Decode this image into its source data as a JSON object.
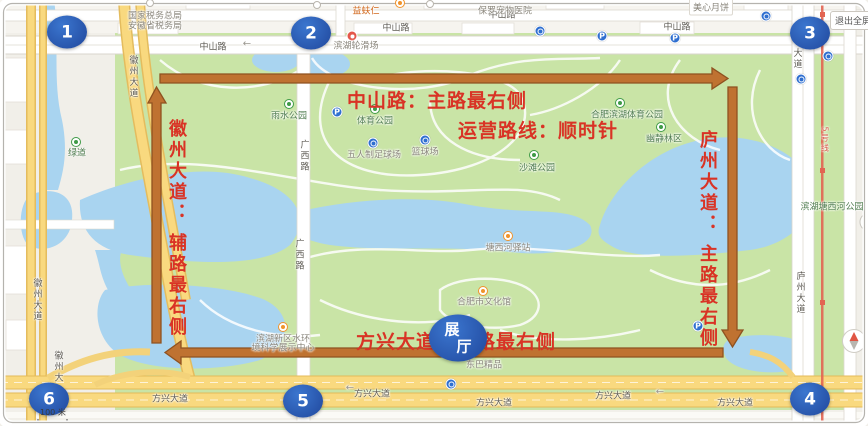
{
  "ui": {
    "exit_fullscreen": "退出全屏",
    "scale_text": "100 米"
  },
  "annotations": {
    "top_road": "中山路：主路最右侧",
    "route_direction": "运营路线：顺时针",
    "left_road": "徽州大道： 辅路最右侧",
    "right_road": "庐州大道： 主路最右侧",
    "bottom_road": "方兴大道：主路最右侧",
    "hall_top": "展",
    "hall_bottom": "厅"
  },
  "colors": {
    "annotation_red": "#d93325",
    "arrow_orange": "#bf7231",
    "marker_blue": "#2a5cb0",
    "water": "#a9d4f0",
    "park_green": "#c9e4a6",
    "road_yellow": "#f8d77c"
  },
  "route_markers": [
    {
      "n": "1",
      "x": 67,
      "y": 32
    },
    {
      "n": "2",
      "x": 311,
      "y": 33
    },
    {
      "n": "3",
      "x": 810,
      "y": 33
    },
    {
      "n": "4",
      "x": 810,
      "y": 399
    },
    {
      "n": "5",
      "x": 303,
      "y": 401
    },
    {
      "n": "6",
      "x": 49,
      "y": 399
    }
  ],
  "map_labels": [
    {
      "t": "国家税务总局",
      "x": 155,
      "y": 15,
      "cls": "bldg"
    },
    {
      "t": "安徽省税务局",
      "x": 155,
      "y": 25,
      "cls": "bldg"
    },
    {
      "t": "中山路",
      "x": 213,
      "y": 46,
      "cls": "road"
    },
    {
      "t": "中山路",
      "x": 396,
      "y": 27,
      "cls": "road"
    },
    {
      "t": "中山路",
      "x": 502,
      "y": 14,
      "cls": "road"
    },
    {
      "t": "中山路",
      "x": 677,
      "y": 26,
      "cls": "road"
    },
    {
      "t": "益蚨仁",
      "x": 366,
      "y": 10,
      "cls": "orange"
    },
    {
      "t": "保罗宠物医院",
      "x": 505,
      "y": 10,
      "cls": "bldg"
    },
    {
      "t": "美心月饼",
      "x": 711,
      "y": 7,
      "cls": "bldg bubble"
    },
    {
      "t": "滨湖轮滑场",
      "x": 356,
      "y": 45,
      "cls": "bldg"
    },
    {
      "t": "雨水公园",
      "x": 289,
      "y": 115,
      "cls": "park"
    },
    {
      "t": "体育公园",
      "x": 375,
      "y": 120,
      "cls": "park"
    },
    {
      "t": "五人制足球场",
      "x": 374,
      "y": 154,
      "cls": "bldg"
    },
    {
      "t": "篮球场",
      "x": 425,
      "y": 151,
      "cls": "bldg"
    },
    {
      "t": "沙滩公园",
      "x": 537,
      "y": 167,
      "cls": "park"
    },
    {
      "t": "合肥滨湖体育公园",
      "x": 627,
      "y": 114,
      "cls": "park"
    },
    {
      "t": "幽静林区",
      "x": 664,
      "y": 138,
      "cls": "park"
    },
    {
      "t": "滨湖塘西河公园",
      "x": 832,
      "y": 206,
      "cls": "park"
    },
    {
      "t": "塘西河驿站",
      "x": 508,
      "y": 247,
      "cls": "bldg"
    },
    {
      "t": "合肥市文化馆",
      "x": 484,
      "y": 301,
      "cls": "bldg"
    },
    {
      "t": "滨湖新区水环",
      "x": 283,
      "y": 338,
      "cls": "bldg"
    },
    {
      "t": "境科学展示中心",
      "x": 283,
      "y": 347,
      "cls": "bldg"
    },
    {
      "t": "东巴精品",
      "x": 484,
      "y": 364,
      "cls": "bldg"
    },
    {
      "t": "方兴大道",
      "x": 170,
      "y": 398,
      "cls": "road"
    },
    {
      "t": "方兴大道",
      "x": 372,
      "y": 393,
      "cls": "road"
    },
    {
      "t": "方兴大道",
      "x": 494,
      "y": 402,
      "cls": "road"
    },
    {
      "t": "方兴大道",
      "x": 613,
      "y": 395,
      "cls": "road"
    },
    {
      "t": "方兴大道",
      "x": 735,
      "y": 402,
      "cls": "road"
    },
    {
      "t": "广西路",
      "x": 304,
      "y": 156,
      "cls": "road",
      "v": true
    },
    {
      "t": "广西路",
      "x": 299,
      "y": 255,
      "cls": "road",
      "v": true
    },
    {
      "t": "徽州大道",
      "x": 133,
      "y": 77,
      "cls": "road",
      "v": true
    },
    {
      "t": "徽州大道",
      "x": 37,
      "y": 300,
      "cls": "road",
      "v": true
    },
    {
      "t": "徽州大",
      "x": 58,
      "y": 367,
      "cls": "road",
      "v": true
    },
    {
      "t": "大道",
      "x": 797,
      "y": 59,
      "cls": "road",
      "v": true
    },
    {
      "t": "庐州大道",
      "x": 800,
      "y": 293,
      "cls": "road",
      "v": true
    },
    {
      "t": "绿道",
      "x": 77,
      "y": 152,
      "cls": "park"
    },
    {
      "t": "5号线",
      "x": 825,
      "y": 140,
      "cls": "metro",
      "v": true
    },
    {
      "t": "←",
      "x": 247,
      "y": 44,
      "cls": "dir"
    },
    {
      "t": "←",
      "x": 350,
      "y": 388,
      "cls": "dir"
    },
    {
      "t": "←",
      "x": 660,
      "y": 392,
      "cls": "dir"
    }
  ],
  "poi_icons": [
    {
      "type": "parking-icon",
      "x": 337,
      "y": 112,
      "g": "P"
    },
    {
      "type": "parking-icon",
      "x": 602,
      "y": 36,
      "g": "P"
    },
    {
      "type": "parking-icon",
      "x": 675,
      "y": 38,
      "g": "P"
    },
    {
      "type": "parking-icon",
      "x": 698,
      "y": 326,
      "g": "P"
    },
    {
      "type": "transit-icon",
      "x": 766,
      "y": 16
    },
    {
      "type": "transit-icon",
      "x": 828,
      "y": 56
    },
    {
      "type": "transit-icon",
      "x": 801,
      "y": 79
    },
    {
      "type": "transit-icon",
      "x": 451,
      "y": 384
    },
    {
      "type": "transit-icon",
      "x": 540,
      "y": 31
    },
    {
      "type": "sport-icon",
      "x": 373,
      "y": 143
    },
    {
      "type": "sport-icon",
      "x": 425,
      "y": 140
    },
    {
      "type": "park-icon",
      "x": 289,
      "y": 104
    },
    {
      "type": "park-icon",
      "x": 375,
      "y": 109
    },
    {
      "type": "park-icon",
      "x": 620,
      "y": 103
    },
    {
      "type": "park-icon",
      "x": 661,
      "y": 127
    },
    {
      "type": "park-icon",
      "x": 534,
      "y": 155
    },
    {
      "type": "park-icon",
      "x": 76,
      "y": 142
    },
    {
      "type": "orange-icon",
      "x": 483,
      "y": 291
    },
    {
      "type": "orange-icon",
      "x": 283,
      "y": 327
    },
    {
      "type": "orange-icon",
      "x": 508,
      "y": 236
    },
    {
      "type": "orange-icon",
      "x": 400,
      "y": 3
    },
    {
      "type": "red-icon",
      "x": 352,
      "y": 36
    },
    {
      "type": "white-icon",
      "x": 430,
      "y": 4
    },
    {
      "type": "white-icon",
      "x": 150,
      "y": 3
    },
    {
      "type": "white-icon",
      "x": 317,
      "y": 5
    }
  ]
}
